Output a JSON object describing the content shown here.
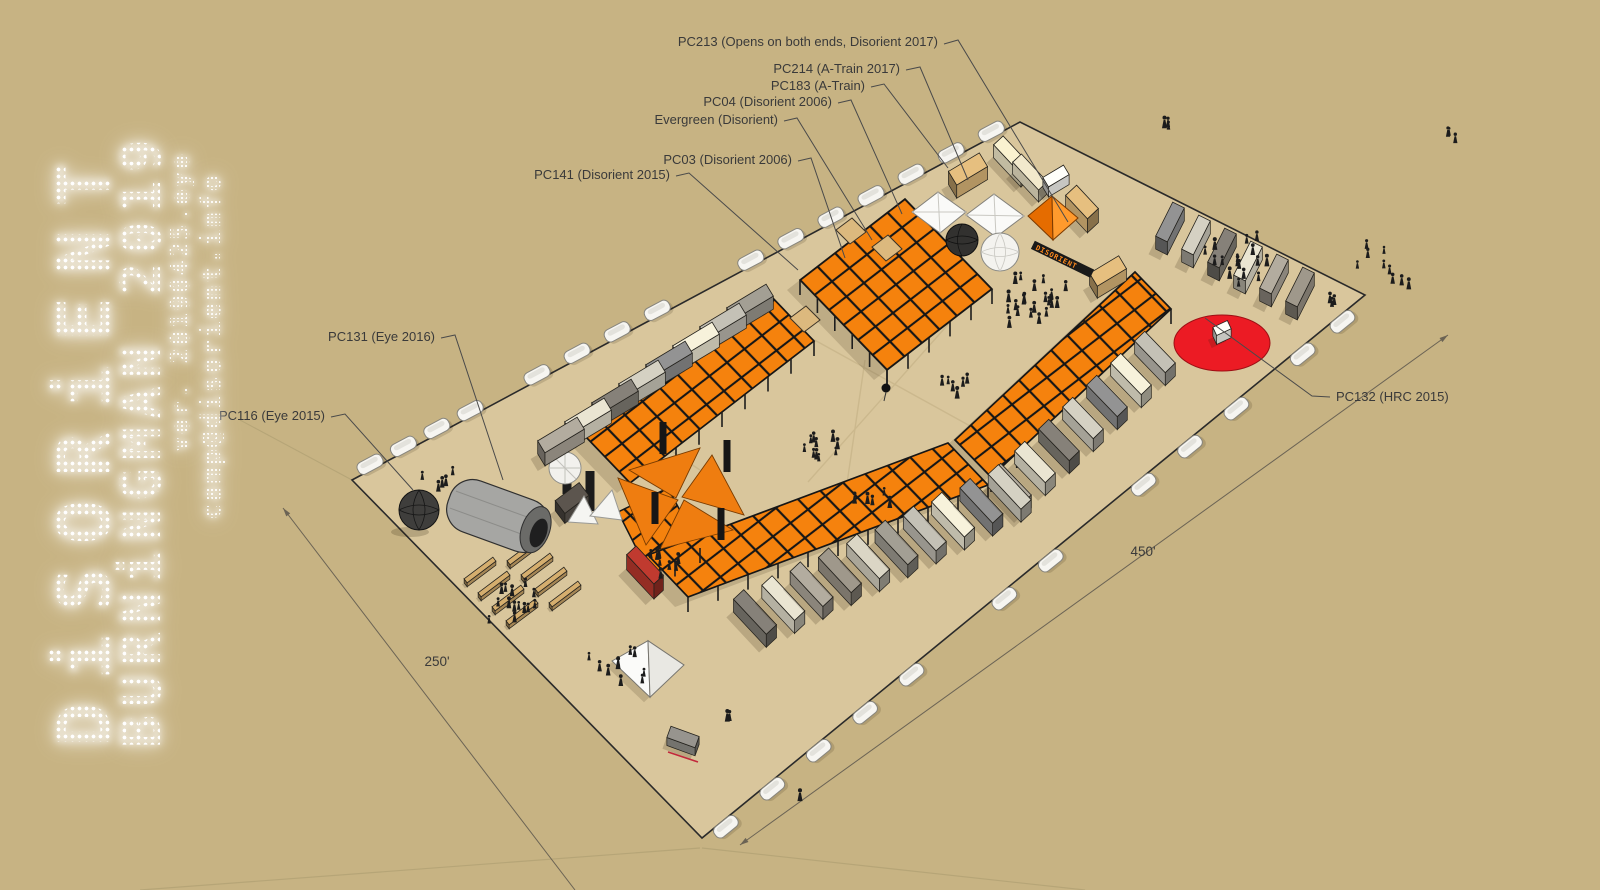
{
  "title": "Disorient Burningman 2019 camp plan",
  "colors": {
    "background": "#c7b383",
    "plot_ground": "#d9c69c",
    "plot_edge": "#2a2a2a",
    "canopy_orange": "#f5820d",
    "canopy_frame": "#161616",
    "tan_cell": "#dcb97e",
    "red_circle": "#ec1b24",
    "red_bus": "#b5372c",
    "label_text": "#3a3a3a",
    "leader_line": "#4a4a4a",
    "dimension_line": "#6b6354",
    "sign_bg": "#1a1a1a",
    "sign_text": "#ff8a1e",
    "logo_text": "#ffffff"
  },
  "logo": {
    "line1": "DiSORiENT",
    "line2": "BURNiNGMAN 2019",
    "line3": "ver. 20190425.eye",
    "line4": "camp@disorient.info"
  },
  "sign": {
    "text": "DISORIENT"
  },
  "labels": [
    {
      "id": "pc213",
      "text": "PC213 (Opens on both ends, Disorient 2017)",
      "x": 938,
      "y": 46,
      "anchor": "end",
      "leader": [
        [
          944,
          44
        ],
        [
          958,
          40
        ],
        [
          1068,
          222
        ]
      ]
    },
    {
      "id": "pc214",
      "text": "PC214 (A-Train 2017)",
      "x": 900,
      "y": 73,
      "anchor": "end",
      "leader": [
        [
          906,
          70
        ],
        [
          920,
          67
        ],
        [
          968,
          180
        ]
      ]
    },
    {
      "id": "pc183",
      "text": "PC183 (A-Train)",
      "x": 865,
      "y": 90,
      "anchor": "end",
      "leader": [
        [
          871,
          87
        ],
        [
          884,
          84
        ],
        [
          948,
          168
        ]
      ]
    },
    {
      "id": "pc04",
      "text": "PC04 (Disorient 2006)",
      "x": 832,
      "y": 106,
      "anchor": "end",
      "leader": [
        [
          838,
          103
        ],
        [
          851,
          100
        ],
        [
          902,
          214
        ]
      ]
    },
    {
      "id": "evergreen",
      "text": "Evergreen (Disorient)",
      "x": 778,
      "y": 124,
      "anchor": "end",
      "leader": [
        [
          784,
          121
        ],
        [
          797,
          118
        ],
        [
          872,
          240
        ]
      ]
    },
    {
      "id": "pc03",
      "text": "PC03 (Disorient 2006)",
      "x": 792,
      "y": 164,
      "anchor": "end",
      "leader": [
        [
          798,
          161
        ],
        [
          811,
          158
        ],
        [
          845,
          258
        ]
      ]
    },
    {
      "id": "pc141",
      "text": "PC141 (Disorient 2015)",
      "x": 670,
      "y": 179,
      "anchor": "end",
      "leader": [
        [
          676,
          176
        ],
        [
          689,
          173
        ],
        [
          798,
          270
        ]
      ]
    },
    {
      "id": "pc131",
      "text": "PC131 (Eye 2016)",
      "x": 435,
      "y": 341,
      "anchor": "end",
      "leader": [
        [
          441,
          338
        ],
        [
          455,
          335
        ],
        [
          503,
          480
        ]
      ]
    },
    {
      "id": "pc116",
      "text": "PC116 (Eye 2015)",
      "x": 325,
      "y": 420,
      "anchor": "end",
      "leader": [
        [
          331,
          417
        ],
        [
          345,
          414
        ],
        [
          413,
          490
        ]
      ]
    },
    {
      "id": "pc132",
      "text": "PC132 (HRC 2015)",
      "x": 1336,
      "y": 401,
      "anchor": "start",
      "leader": [
        [
          1330,
          397
        ],
        [
          1312,
          396
        ],
        [
          1205,
          318
        ]
      ]
    }
  ],
  "dimensions": [
    {
      "id": "d450",
      "text": "450'",
      "tx": 1143,
      "ty": 556,
      "line": [
        [
          740,
          845
        ],
        [
          1448,
          335
        ]
      ],
      "arrows": [
        "start",
        "end"
      ]
    },
    {
      "id": "d250",
      "text": "250'",
      "tx": 437,
      "ty": 666,
      "line": [
        [
          283,
          508
        ],
        [
          575,
          890
        ]
      ],
      "arrows": [
        "start"
      ]
    }
  ]
}
